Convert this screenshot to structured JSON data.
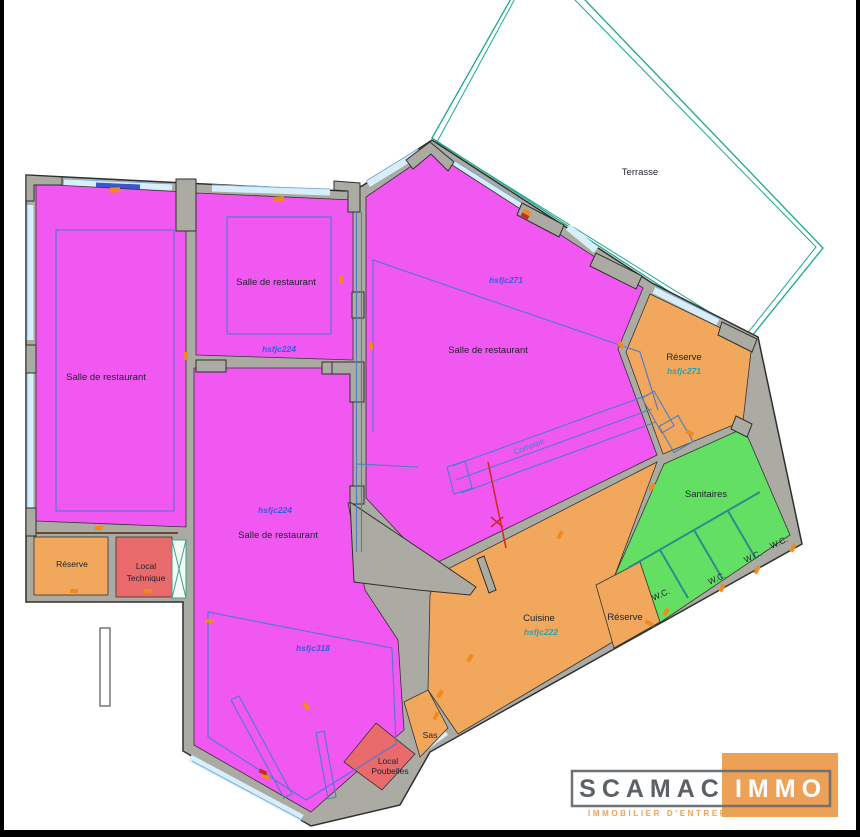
{
  "plan": {
    "labels": {
      "terrasse": "Terrasse",
      "salle_left": "Salle de restaurant",
      "salle_mid_top": "Salle de restaurant",
      "salle_mid_top_code": "hsfjc224",
      "salle_central_code": "hsfjc224",
      "salle_central": "Salle de restaurant",
      "salle_central_code2": "hsfjc318",
      "salle_right_code": "hsfjc271",
      "salle_right": "Salle de restaurant",
      "comptoir": "Comptoir",
      "reserve_right": "Réserve",
      "reserve_right_code": "hsfjc271",
      "sanitaires": "Sanitaires",
      "wc1": "W.C.",
      "wc2": "W.C.",
      "wc3": "W.C.",
      "wc4": "W.C.",
      "cuisine": "Cuisine",
      "cuisine_code": "hsfjc222",
      "reserve_mid": "Réserve",
      "sas": "Sas",
      "local_poubelles_line1": "Local",
      "local_poubelles_line2": "Poubelles",
      "reserve_left": "Réserve",
      "local_technique_line1": "Local",
      "local_technique_line2": "Technique"
    },
    "legend_colors": {
      "magenta": "#F158F1",
      "orange": "#F2A85C",
      "green": "#63E063",
      "red": "#E96A6A",
      "wall_gray": "#ABABA3",
      "window_blue": "#D9EEFB",
      "terrasse_teal": "#1BA88C",
      "detail_blue": "#4E7EC0",
      "code_blue": "#2F5FE0",
      "code_teal": "#2E9FB0",
      "door_orange": "#F08A1E",
      "section_red": "#CC2A1E",
      "logo_orange": "#EDA157",
      "logo_gray": "#5C6165"
    },
    "logo": {
      "brand_left": "SCAMAC",
      "brand_right": "IMMO",
      "tagline": "IMMOBILIER D'ENTREPRISE"
    }
  }
}
